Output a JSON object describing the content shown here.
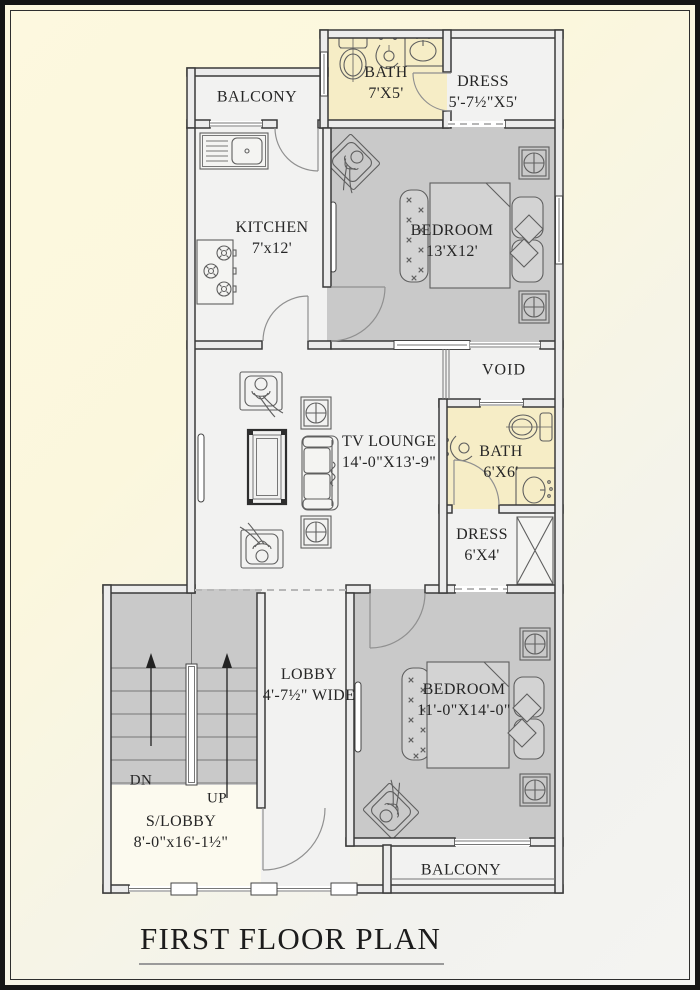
{
  "title": "FIRST FLOOR PLAN",
  "colors": {
    "wall_line": "#3a3a3a",
    "wall_fill": "#ececec",
    "bedroom_floor": "#c9c9c9",
    "bath_floor": "#f6edc6",
    "room_floor": "#f2f2f1",
    "slobby_floor": "#fcfaef",
    "furniture_line": "#5f5f5f",
    "label_color": "#262626"
  },
  "rooms": {
    "balcony_top": {
      "label": "BALCONY"
    },
    "bath_top": {
      "label": "BATH",
      "dims": "7'X5'"
    },
    "dress_top": {
      "label": "DRESS",
      "dims": "5'-7½\"X5'"
    },
    "kitchen": {
      "label": "KITCHEN",
      "dims": "7'x12'"
    },
    "bedroom_top": {
      "label": "BEDROOM",
      "dims": "13'X12'"
    },
    "void": {
      "label": "VOID"
    },
    "tv_lounge": {
      "label": "TV LOUNGE",
      "dims": "14'-0\"X13'-9\""
    },
    "bath_mid": {
      "label": "BATH",
      "dims": "6'X6'"
    },
    "dress_mid": {
      "label": "DRESS",
      "dims": "6'X4'"
    },
    "lobby": {
      "label": "LOBBY",
      "dims": "4'-7½\" WIDE"
    },
    "stairs": {
      "down_label": "DN",
      "up_label": "UP"
    },
    "s_lobby": {
      "label": "S/LOBBY",
      "dims": "8'-0\"x16'-1½\""
    },
    "bedroom_bottom": {
      "label": "BEDROOM",
      "dims": "11'-0\"X14'-0\""
    },
    "balcony_bottom": {
      "label": "BALCONY"
    }
  }
}
